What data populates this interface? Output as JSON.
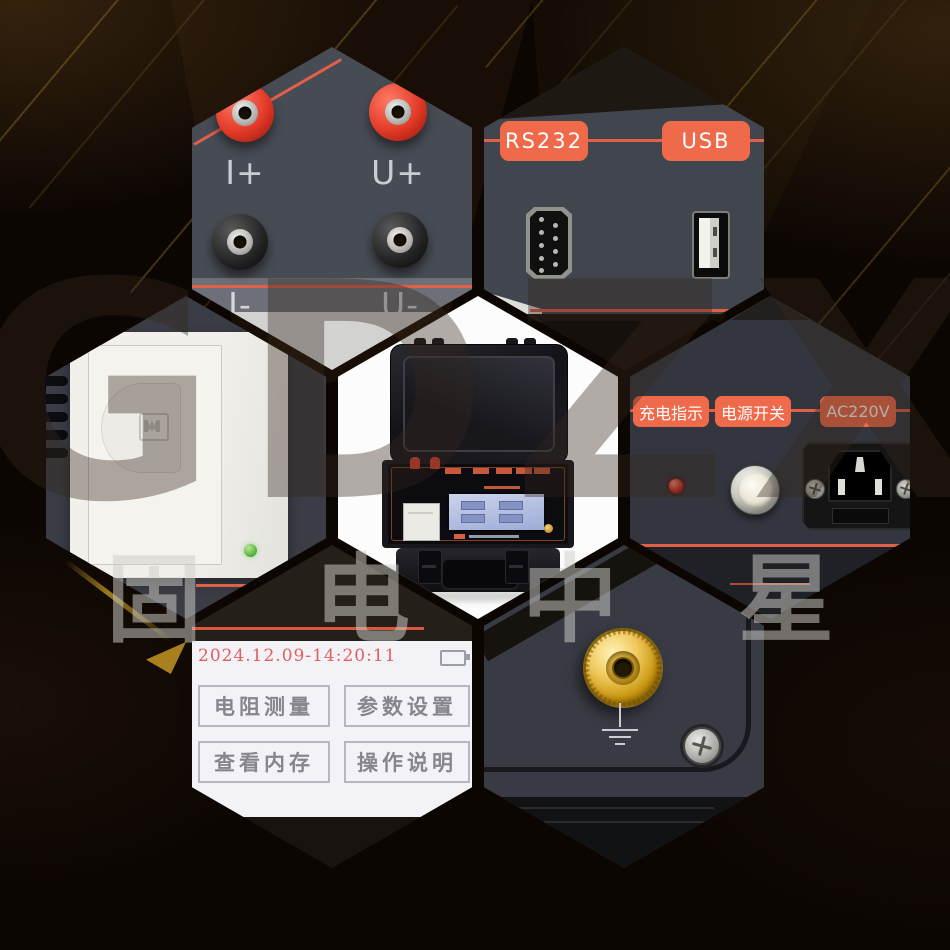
{
  "watermark": {
    "latin": "GDZX",
    "cn": [
      "固",
      "电",
      "中",
      "星"
    ]
  },
  "hex_terminals": {
    "i_plus": "I+",
    "u_plus": "U+",
    "i_minus": "I-",
    "u_minus": "U-"
  },
  "hex_ports": {
    "rs232": "RS232",
    "usb": "USB"
  },
  "hex_power": {
    "labels": [
      "充电指示",
      "电源开关",
      "AC220V"
    ]
  },
  "hex_screen": {
    "datetime": "2024.12.09-14:20:11",
    "buttons": [
      "电阻测量",
      "参数设置",
      "查看内存",
      "操作说明"
    ]
  },
  "icons": {
    "ground": "earth-ground-symbol",
    "battery": "battery-level-icon",
    "power_button": "power-push-button",
    "charge_led": "red-charge-indicator-led",
    "printer_led": "green-status-led",
    "rs232_port": "db9-serial-port",
    "usb_port": "usb-a-port"
  },
  "colors": {
    "accent": "#ef6a4a",
    "accent_line": "#e0604a",
    "panel": "#474b54",
    "background": "#0c0603",
    "screen": "#f3f2f6",
    "datetime_red": "#e06565",
    "gold": "#d9aa3e",
    "led_green": "#5cb83e",
    "led_red": "#cf2d20"
  }
}
